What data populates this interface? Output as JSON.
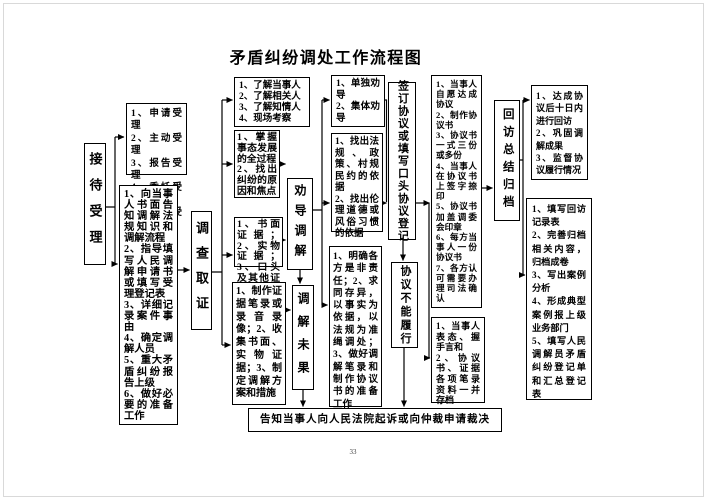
{
  "title": "矛盾纠纷调处工作流程图",
  "page_number": "33",
  "stages": {
    "reception": "接待受理",
    "investigation": "调查取证",
    "persuasion": "劝导调解",
    "mediation_failed": "调解未果",
    "sign_agreement": "签订协议或填写口头协议登记",
    "agreement_unfulfilled": "协议不能履行",
    "followup": "回访总结归档"
  },
  "boxes": {
    "acceptance_methods": "1、申请受理\n2、主动受理\n3、报告受理\n4、委托受理\n5、指定受理",
    "reception_tasks": "1、向当事人书面告知调解法规知识和调解流程\n2、指导填写人民调解申请书或填写受理登记表\n3、详细记录案件事由\n4、确定调解人员\n5、重大矛盾纠纷报告上级\n6、做好必要的准备工作",
    "investigation_targets": "1、了解当事人\n2、了解相关人\n3、了解知情人\n4、现场考察",
    "investigation_goals": "1、掌握事态发展的全过程\n2、找出纠纷的原因和焦点",
    "evidence_types": "1、书面证据；2、实物证据；3、口头及其他证据",
    "evidence_preparation": "1、制作证据笔录或录音录像；2、收集书面、实物证据；3、制定调解方案和措施",
    "persuasion_methods": "1、单独劝导\n2、集体劝导",
    "persuasion_basis": "1、找出法规、政策、村规民约的依据\n2、找出伦理道德或风俗习惯的依据",
    "mediation_principles": "1、明确各方是非责任；2、求同存异，以事实为依据，以法规为准绳调处；3、做好调解笔录和制作协议书的准备工作",
    "agreement_steps": "1、当事人自愿达成协议\n2、制作协议书\n3、协议书一式三份或多份\n4、当事人在协议书上签字捺印\n5、协议书加盖调委会印章\n6、每方当事人一份协议书\n7、各方认可需要办理司法确认",
    "archive_materials": "1、当事人表态、握手言和\n2、协议书、证据各项笔录资料一并存档",
    "followup_tasks": "1、达成协议后十日内进行回访\n2、巩固调解成果\n3、监督协议履行情况",
    "archive_tasks": "1、填写回访记录表\n2、完善归档相关内容，归档成卷\n3、写出案例分析\n4、形成典型案例报上级业务部门\n5、填写人民调解员矛盾纠纷登记单和汇总登记表",
    "litigation_notice": "告知当事人向人民法院起诉或向仲裁申请裁决"
  }
}
